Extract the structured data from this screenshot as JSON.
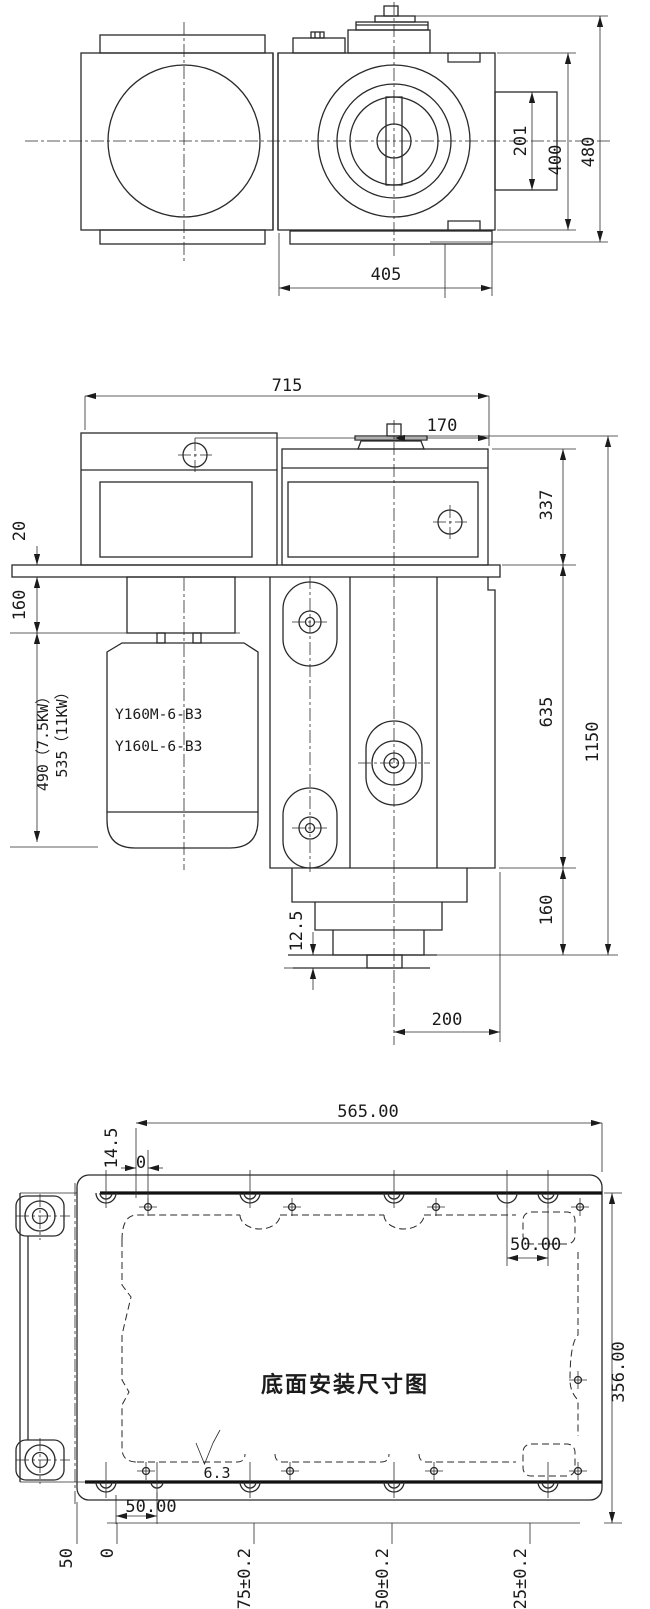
{
  "drawing": {
    "top_view": {
      "d201": "201",
      "d400": "400",
      "d480": "480",
      "d405": "405"
    },
    "front_view": {
      "d715": "715",
      "d170": "170",
      "d337": "337",
      "d20": "20",
      "d160_left": "160",
      "d490": "490（7.5KW）",
      "d535": "535（11KW）",
      "motor_model_1": "Y160M-6-B3",
      "motor_model_2": "Y160L-6-B3",
      "d635": "635",
      "d1150": "1150",
      "d160_right": "160",
      "d12_5": "12.5",
      "d200": "200"
    },
    "bottom_view": {
      "title": "底面安装尺寸图",
      "roughness": "6.3",
      "d565": "565.00",
      "d14_5": "14.5",
      "d0_top": "0",
      "d50_top_right": "50.00",
      "d356": "356.00",
      "d50_bottom": "50.00",
      "axis_50": "50",
      "axis_0": "0",
      "axis_175": "175±0.2",
      "axis_350": "350±0.2",
      "axis_525": "525±0.2"
    },
    "line_color": "#2a2a2a",
    "paper_color": "#ffffff"
  }
}
